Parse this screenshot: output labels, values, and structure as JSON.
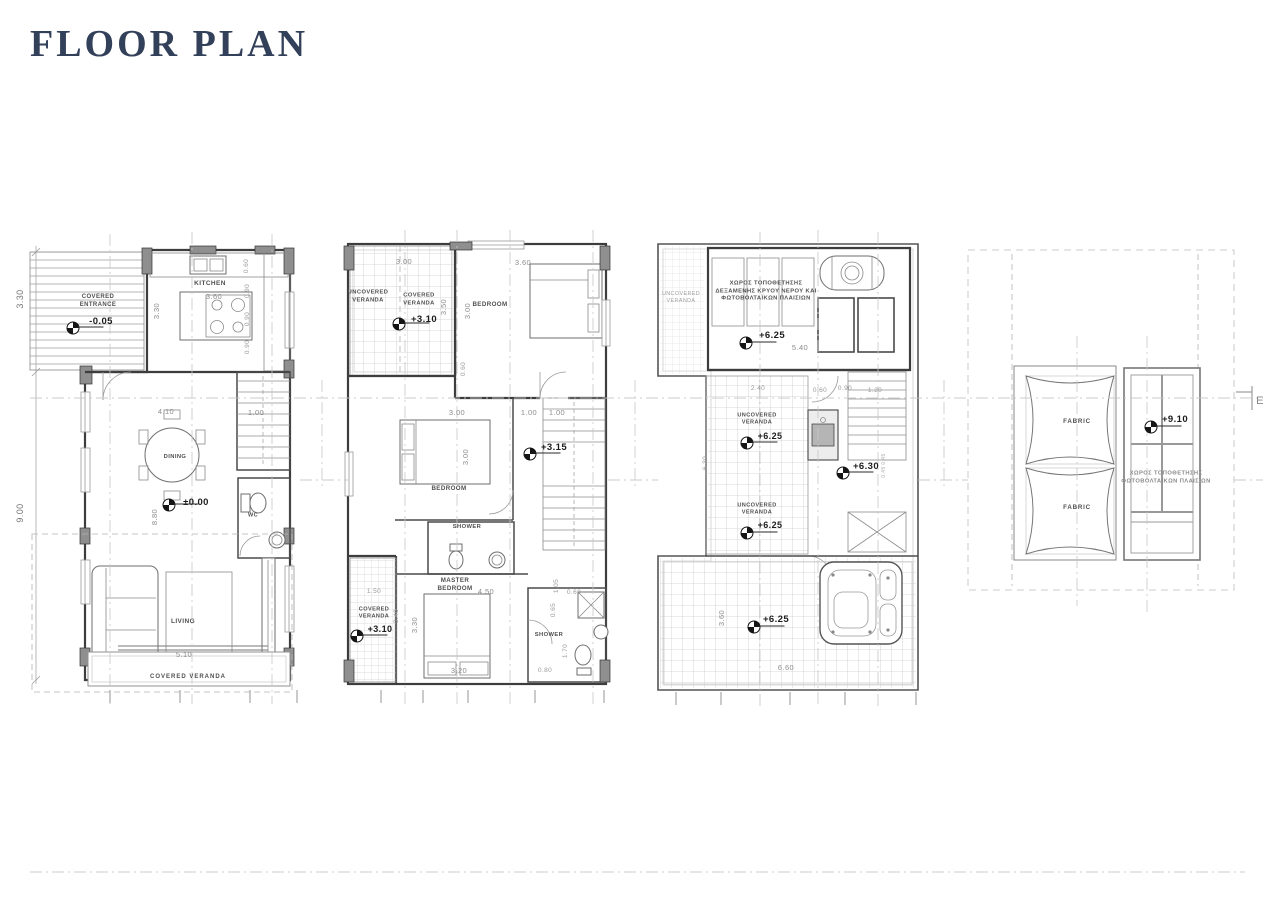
{
  "title": "FLOOR PLAN",
  "colors": {
    "background": "#ffffff",
    "title_text": "#33405a",
    "linework": "#3d3d3d",
    "dim_text": "#8d8d8d",
    "room_label_text": "#4f4f4f",
    "level_text": "#1c1c1c"
  },
  "plans": [
    {
      "id": "ground-floor",
      "rooms": [
        "COVERED ENTRANCE",
        "KITCHEN",
        "DINING",
        "WC",
        "LIVING",
        "COVERED VERANDA"
      ],
      "levels": [
        "-0.05",
        "±0.00"
      ]
    },
    {
      "id": "first-floor",
      "rooms": [
        "UNCOVERED VERANDA",
        "COVERED VERANDA",
        "BEDROOM",
        "BEDROOM",
        "SHOWER",
        "MASTER BEDROOM",
        "SHOWER",
        "COVERED VERANDA"
      ],
      "levels": [
        "+3.10",
        "+3.15",
        "+3.10"
      ]
    },
    {
      "id": "roof-terrace",
      "rooms": [
        "UNCOVERED VERANDA",
        "ΧΩΡΟΣ ΤΟΠΟΘΕΤΗΣΗΣ ΔΕΞΑΜΕΝΗΣ ΚΡΥΟΥ ΝΕΡΟΥ ΚΑΙ ΦΩΤΟΒΟΛΤΑΪΚΩΝ ΠΛΑΙΣΙΩΝ"
      ],
      "levels": [
        "+6.25",
        "+6.25",
        "+6.30",
        "+6.25",
        "+6.25"
      ]
    },
    {
      "id": "top-roof",
      "rooms": [
        "FABRIC",
        "FABRIC",
        "ΧΩΡΟΣ ΤΟΠΟΘΕΤΗΣΗΣ ΦΩΤΟΒΟΛΤΑΪΚΩΝ ΠΛΑΙΣΙΩΝ"
      ],
      "levels": [
        "+9.10"
      ]
    }
  ],
  "labels": [
    {
      "n": "p1-room-covered-entrance",
      "t": "COVERED\nENTRANCE",
      "x": 98,
      "y": 302,
      "s": 6,
      "w": 700
    },
    {
      "n": "p1-level-entrance",
      "t": "-0.05",
      "x": 101,
      "y": 322,
      "s": 9.5,
      "w": 700,
      "c": "#1c1c1c"
    },
    {
      "n": "p1-room-kitchen",
      "t": "KITCHEN",
      "x": 210,
      "y": 284,
      "s": 6.5,
      "w": 700
    },
    {
      "n": "p1-dim-kitchen-w",
      "t": "3.60",
      "x": 214,
      "y": 297,
      "s": 7.5,
      "c": "#8d8d8d"
    },
    {
      "n": "p1-dim-kitchen-h",
      "t": "3.30",
      "x": 157,
      "y": 311,
      "s": 7.5,
      "r": -90,
      "c": "#8d8d8d"
    },
    {
      "n": "p1-dim-060",
      "t": "0.60",
      "x": 247,
      "y": 266,
      "s": 6.5,
      "r": -90,
      "c": "#9a9a9a"
    },
    {
      "n": "p1-dim-090a",
      "t": "0.90",
      "x": 248,
      "y": 291,
      "s": 6.5,
      "r": -90,
      "c": "#9a9a9a"
    },
    {
      "n": "p1-dim-090b",
      "t": "0.90",
      "x": 248,
      "y": 319,
      "s": 6.5,
      "r": -90,
      "c": "#9a9a9a"
    },
    {
      "n": "p1-dim-090c",
      "t": "0.90",
      "x": 248,
      "y": 347,
      "s": 6.5,
      "r": -90,
      "c": "#9a9a9a"
    },
    {
      "n": "p1-dim-330-left",
      "t": "3.30",
      "x": 21,
      "y": 299,
      "s": 9,
      "r": -90,
      "c": "#777777"
    },
    {
      "n": "p1-dim-900-left",
      "t": "9.00",
      "x": 21,
      "y": 513,
      "s": 9,
      "r": -90,
      "c": "#777777"
    },
    {
      "n": "p1-dim-410",
      "t": "4.10",
      "x": 166,
      "y": 412,
      "s": 7.5,
      "c": "#8d8d8d"
    },
    {
      "n": "p1-dim-100",
      "t": "1.00",
      "x": 256,
      "y": 413,
      "s": 7.5,
      "c": "#8d8d8d"
    },
    {
      "n": "p1-room-dining",
      "t": "DINING",
      "x": 175,
      "y": 458,
      "s": 5.8,
      "w": 700
    },
    {
      "n": "p1-level-ground",
      "t": "±0.00",
      "x": 196,
      "y": 503,
      "s": 9.5,
      "w": 700,
      "c": "#1c1c1c"
    },
    {
      "n": "p1-dim-880",
      "t": "8.80",
      "x": 155,
      "y": 517,
      "s": 7.5,
      "r": -90,
      "c": "#8d8d8d"
    },
    {
      "n": "p1-room-wc",
      "t": "WC",
      "x": 253,
      "y": 516,
      "s": 5.5,
      "w": 700
    },
    {
      "n": "p1-room-living",
      "t": "LIVING",
      "x": 183,
      "y": 622,
      "s": 6.5,
      "w": 700
    },
    {
      "n": "p1-dim-510",
      "t": "5.10",
      "x": 184,
      "y": 655,
      "s": 7.5,
      "c": "#8d8d8d"
    },
    {
      "n": "p1-area-covered-veranda",
      "t": "COVERED VERANDA",
      "x": 188,
      "y": 678,
      "s": 6,
      "w": 700,
      "ls": 1
    },
    {
      "n": "p2-area-uncovered-veranda",
      "t": "UNCOVERED\nVERANDA",
      "x": 368,
      "y": 297,
      "s": 5.8,
      "w": 700
    },
    {
      "n": "p2-area-covered-veranda-top",
      "t": "COVERED\nVERANDA",
      "x": 419,
      "y": 300,
      "s": 5.8,
      "w": 700
    },
    {
      "n": "p2-level-veranda-top",
      "t": "+3.10",
      "x": 424,
      "y": 320,
      "s": 9.5,
      "w": 700,
      "c": "#1c1c1c"
    },
    {
      "n": "p2-dim-300a",
      "t": "3.00",
      "x": 404,
      "y": 262,
      "s": 7.5,
      "c": "#8d8d8d"
    },
    {
      "n": "p2-dim-350",
      "t": "3.50",
      "x": 444,
      "y": 307,
      "s": 7.5,
      "r": -90,
      "c": "#8d8d8d"
    },
    {
      "n": "p2-dim-300b",
      "t": "3.00",
      "x": 468,
      "y": 311,
      "s": 7.5,
      "r": -90,
      "c": "#8d8d8d"
    },
    {
      "n": "p2-room-bedroom1",
      "t": "BEDROOM",
      "x": 490,
      "y": 305,
      "s": 6.2,
      "w": 700
    },
    {
      "n": "p2-dim-360",
      "t": "3.60",
      "x": 523,
      "y": 263,
      "s": 7.5,
      "c": "#8d8d8d"
    },
    {
      "n": "p2-dim-060",
      "t": "0.60",
      "x": 464,
      "y": 369,
      "s": 6.5,
      "r": -90,
      "c": "#9a9a9a"
    },
    {
      "n": "p2-dim-300c",
      "t": "3.00",
      "x": 457,
      "y": 413,
      "s": 7.5,
      "c": "#8d8d8d"
    },
    {
      "n": "p2-dim-100a",
      "t": "1.00",
      "x": 529,
      "y": 413,
      "s": 7.5,
      "c": "#8d8d8d"
    },
    {
      "n": "p2-dim-100b",
      "t": "1.00",
      "x": 557,
      "y": 413,
      "s": 7.5,
      "c": "#8d8d8d"
    },
    {
      "n": "p2-level-landing",
      "t": "+3.15",
      "x": 554,
      "y": 448,
      "s": 9.5,
      "w": 700,
      "c": "#1c1c1c"
    },
    {
      "n": "p2-dim-300d",
      "t": "3.00",
      "x": 466,
      "y": 457,
      "s": 7.5,
      "r": -90,
      "c": "#8d8d8d"
    },
    {
      "n": "p2-room-bedroom2",
      "t": "BEDROOM",
      "x": 449,
      "y": 489,
      "s": 6.2,
      "w": 700
    },
    {
      "n": "p2-room-shower1",
      "t": "SHOWER",
      "x": 467,
      "y": 528,
      "s": 5.8,
      "w": 700
    },
    {
      "n": "p2-room-master-bedroom",
      "t": "MASTER\nBEDROOM",
      "x": 455,
      "y": 585,
      "s": 6.2,
      "w": 700
    },
    {
      "n": "p2-dim-450",
      "t": "4.50",
      "x": 486,
      "y": 592,
      "s": 7.5,
      "c": "#8d8d8d"
    },
    {
      "n": "p2-dim-150",
      "t": "1.50",
      "x": 374,
      "y": 592,
      "s": 6.5,
      "c": "#9a9a9a"
    },
    {
      "n": "p2-area-covered-veranda-bottom",
      "t": "COVERED\nVERANDA",
      "x": 374,
      "y": 614,
      "s": 5.6,
      "w": 700
    },
    {
      "n": "p2-level-veranda-bottom",
      "t": "+3.10",
      "x": 380,
      "y": 630,
      "s": 9,
      "w": 700,
      "c": "#1c1c1c"
    },
    {
      "n": "p2-dim-340",
      "t": "3.40",
      "x": 397,
      "y": 616,
      "s": 6.5,
      "r": -90,
      "c": "#9a9a9a"
    },
    {
      "n": "p2-dim-330",
      "t": "3.30",
      "x": 415,
      "y": 625,
      "s": 7.5,
      "r": -90,
      "c": "#8d8d8d"
    },
    {
      "n": "p2-dim-320",
      "t": "3.20",
      "x": 459,
      "y": 671,
      "s": 7.5,
      "c": "#8d8d8d"
    },
    {
      "n": "p2-room-shower2",
      "t": "SHOWER",
      "x": 549,
      "y": 636,
      "s": 5.8,
      "w": 700
    },
    {
      "n": "p2-dim-105",
      "t": "1.05",
      "x": 557,
      "y": 586,
      "s": 6.5,
      "r": -90,
      "c": "#9a9a9a"
    },
    {
      "n": "p2-dim-060b",
      "t": "0.60",
      "x": 574,
      "y": 593,
      "s": 6.5,
      "c": "#9a9a9a"
    },
    {
      "n": "p2-dim-065",
      "t": "0.65",
      "x": 554,
      "y": 610,
      "s": 6.5,
      "r": -90,
      "c": "#9a9a9a"
    },
    {
      "n": "p2-dim-170",
      "t": "1.70",
      "x": 566,
      "y": 651,
      "s": 6.5,
      "r": -90,
      "c": "#9a9a9a"
    },
    {
      "n": "p2-dim-080",
      "t": "0.80",
      "x": 545,
      "y": 671,
      "s": 6.5,
      "c": "#9a9a9a"
    },
    {
      "n": "p3-area-uncovered-veranda-strip",
      "t": "UNCOVERED\nVERANDA",
      "x": 681,
      "y": 298,
      "s": 5.4,
      "c": "#a2a2a2"
    },
    {
      "n": "p3-note-tank-pv",
      "t": "ΧΩΡΟΣ ΤΟΠΟΘΕΤΗΣΗΣ\nΔΕΞΑΜΕΝΗΣ ΚΡΥΟΥ ΝΕΡΟΥ ΚΑΙ\nΦΩΤΟΒΟΛΤΑΪΚΩΝ ΠΛΑΙΣΙΩΝ",
      "x": 766,
      "y": 292,
      "s": 5.8,
      "w": 700
    },
    {
      "n": "p3-level-tank",
      "t": "+6.25",
      "x": 772,
      "y": 336,
      "s": 9.5,
      "w": 700,
      "c": "#1c1c1c"
    },
    {
      "n": "p3-dim-540",
      "t": "5.40",
      "x": 800,
      "y": 348,
      "s": 7.5,
      "c": "#8d8d8d"
    },
    {
      "n": "p3-dim-240",
      "t": "2.40",
      "x": 758,
      "y": 389,
      "s": 6.5,
      "c": "#9a9a9a"
    },
    {
      "n": "p3-dim-060",
      "t": "0.60",
      "x": 820,
      "y": 391,
      "s": 6.5,
      "c": "#9a9a9a"
    },
    {
      "n": "p3-dim-090",
      "t": "0.90",
      "x": 845,
      "y": 389,
      "s": 6.5,
      "c": "#9a9a9a"
    },
    {
      "n": "p3-dim-120",
      "t": "1.20",
      "x": 875,
      "y": 391,
      "s": 6.5,
      "c": "#9a9a9a"
    },
    {
      "n": "p3-area-uncovered-veranda-1",
      "t": "UNCOVERED\nVERANDA",
      "x": 757,
      "y": 420,
      "s": 5.6,
      "w": 700
    },
    {
      "n": "p3-level-veranda-1",
      "t": "+6.25",
      "x": 770,
      "y": 437,
      "s": 9,
      "w": 700,
      "c": "#1c1c1c"
    },
    {
      "n": "p3-dim-630",
      "t": "6.30",
      "x": 706,
      "y": 463,
      "s": 6.5,
      "r": -90,
      "c": "#9a9a9a"
    },
    {
      "n": "p3-level-landing",
      "t": "+6.30",
      "x": 866,
      "y": 467,
      "s": 9.5,
      "w": 700,
      "c": "#1c1c1c"
    },
    {
      "n": "p3-dim-045a",
      "t": "0.45",
      "x": 884,
      "y": 459,
      "s": 5,
      "r": -90,
      "c": "#aaaaaa"
    },
    {
      "n": "p3-dim-045b",
      "t": "0.45",
      "x": 884,
      "y": 472,
      "s": 5,
      "r": -90,
      "c": "#aaaaaa"
    },
    {
      "n": "p3-area-uncovered-veranda-2",
      "t": "UNCOVERED\nVERANDA",
      "x": 757,
      "y": 510,
      "s": 5.6,
      "w": 700
    },
    {
      "n": "p3-level-veranda-2",
      "t": "+6.25",
      "x": 770,
      "y": 526,
      "s": 9,
      "w": 700,
      "c": "#1c1c1c"
    },
    {
      "n": "p3-level-terrace",
      "t": "+6.25",
      "x": 776,
      "y": 620,
      "s": 9.5,
      "w": 700,
      "c": "#1c1c1c"
    },
    {
      "n": "p3-dim-360",
      "t": "3.60",
      "x": 722,
      "y": 618,
      "s": 7.5,
      "r": -90,
      "c": "#8d8d8d"
    },
    {
      "n": "p3-dim-660",
      "t": "6.60",
      "x": 786,
      "y": 668,
      "s": 7.5,
      "c": "#8d8d8d"
    },
    {
      "n": "p4-canopy-fabric-1",
      "t": "FABRIC",
      "x": 1077,
      "y": 422,
      "s": 6.2,
      "w": 700,
      "ls": 0.8
    },
    {
      "n": "p4-canopy-fabric-2",
      "t": "FABRIC",
      "x": 1077,
      "y": 508,
      "s": 6.2,
      "w": 700,
      "ls": 0.8
    },
    {
      "n": "p4-level-roof",
      "t": "+9.10",
      "x": 1175,
      "y": 420,
      "s": 9.5,
      "w": 700,
      "c": "#1c1c1c"
    },
    {
      "n": "p4-note-pv",
      "t": "ΧΩΡΟΣ ΤΟΠΟΘΕΤΗΣΗΣ\nΦΩΤΟΒΟΛΤΑΪΚΩΝ ΠΛΑΙΣΙΩΝ",
      "x": 1166,
      "y": 478,
      "s": 5.8,
      "w": 700,
      "c": "#8a8a8a"
    },
    {
      "n": "section-marker-partial",
      "t": "E",
      "x": 1260,
      "y": 401,
      "s": 11,
      "c": "#888888"
    }
  ],
  "level_markers": [
    {
      "n": "level-marker-minus-005",
      "x": 73,
      "y": 328
    },
    {
      "n": "level-marker-000",
      "x": 169,
      "y": 505
    },
    {
      "n": "level-marker-310-top",
      "x": 399,
      "y": 324
    },
    {
      "n": "level-marker-315",
      "x": 530,
      "y": 454
    },
    {
      "n": "level-marker-310-bottom",
      "x": 357,
      "y": 636
    },
    {
      "n": "level-marker-625-tank",
      "x": 746,
      "y": 343
    },
    {
      "n": "level-marker-625-mid1",
      "x": 747,
      "y": 443
    },
    {
      "n": "level-marker-630",
      "x": 843,
      "y": 473
    },
    {
      "n": "level-marker-625-mid2",
      "x": 747,
      "y": 533
    },
    {
      "n": "level-marker-625-terrace",
      "x": 754,
      "y": 627
    },
    {
      "n": "level-marker-910",
      "x": 1151,
      "y": 427
    }
  ]
}
